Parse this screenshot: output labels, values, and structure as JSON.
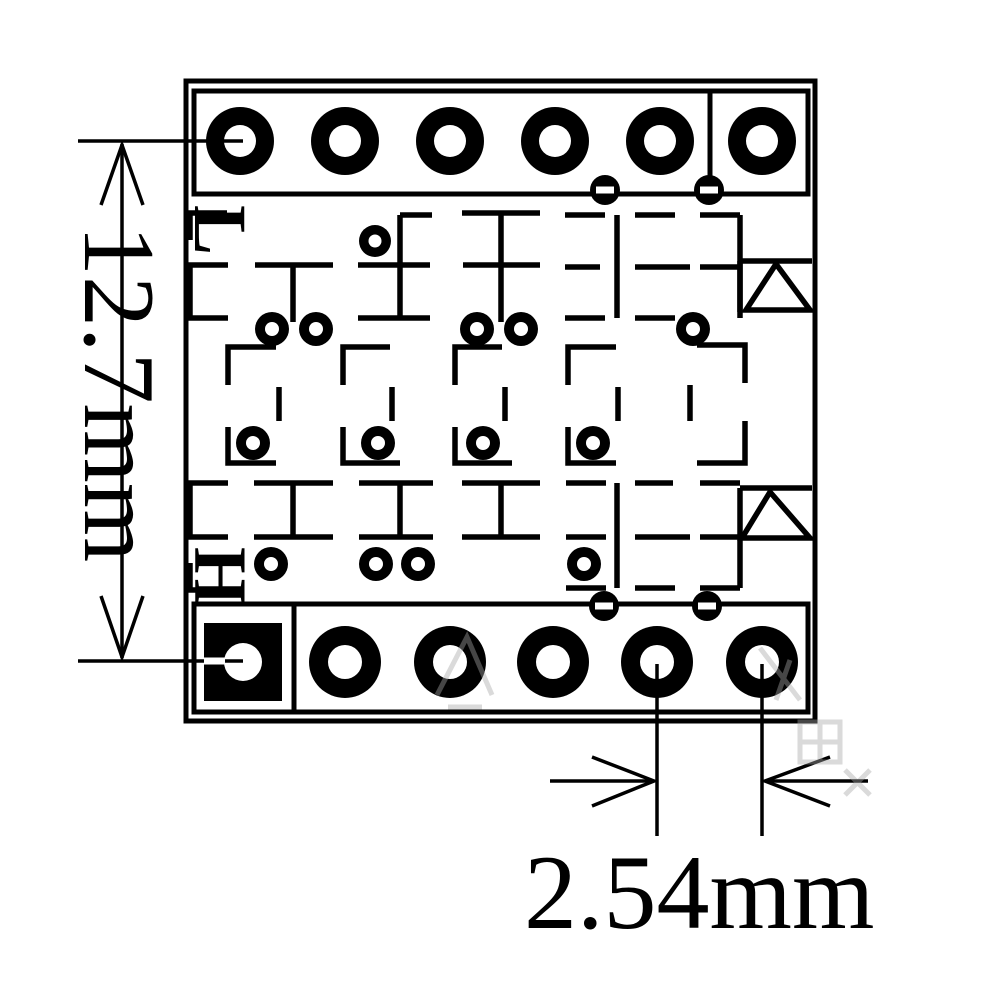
{
  "diagram_labels": {
    "low_side": "L",
    "high_side": "H"
  },
  "dimension_annotations": {
    "row_spacing": "12.7mm",
    "pin_pitch": "2.54mm"
  },
  "colors": {
    "ink": "#000000",
    "background": "#ffffff",
    "watermark": "#a8a8a8"
  }
}
